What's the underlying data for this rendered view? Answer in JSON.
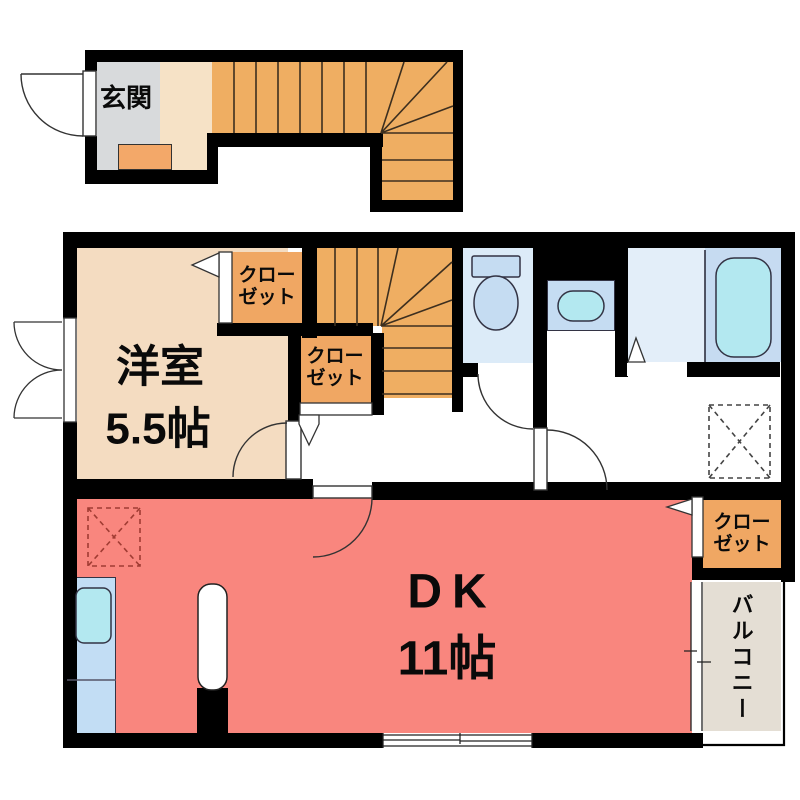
{
  "labels": {
    "entrance": "玄関",
    "western_room": {
      "name": "洋室",
      "size": "5.5帖"
    },
    "dining_kitchen": {
      "name": "DK",
      "size": "11帖"
    },
    "closet": {
      "line1": "クロー",
      "line2": "ゼット",
      "full": "クローゼット"
    },
    "balcony": "バルコニー"
  },
  "colors": {
    "wall": "#000000",
    "line": "#3d2f1f",
    "arc": "#333333",
    "yoshitsu": "#f4dcc1",
    "genkan": "#d8dadc",
    "hall": "#f6e2c6",
    "step": "#f3a869",
    "stair": "#efae62",
    "closet": "#f0a763",
    "dk": "#f9867e",
    "toilet_room": "#dcebf8",
    "bath_wash": "#e3eef9",
    "bath_tub": "#c6dbf1",
    "fixture": "#c5dcf2",
    "cyan": "#b3e8f0",
    "counter": "#c2ddf4",
    "balcony_floor": "#e4ded4",
    "dash_red": "#a03c33",
    "dash_gray": "#444444"
  }
}
